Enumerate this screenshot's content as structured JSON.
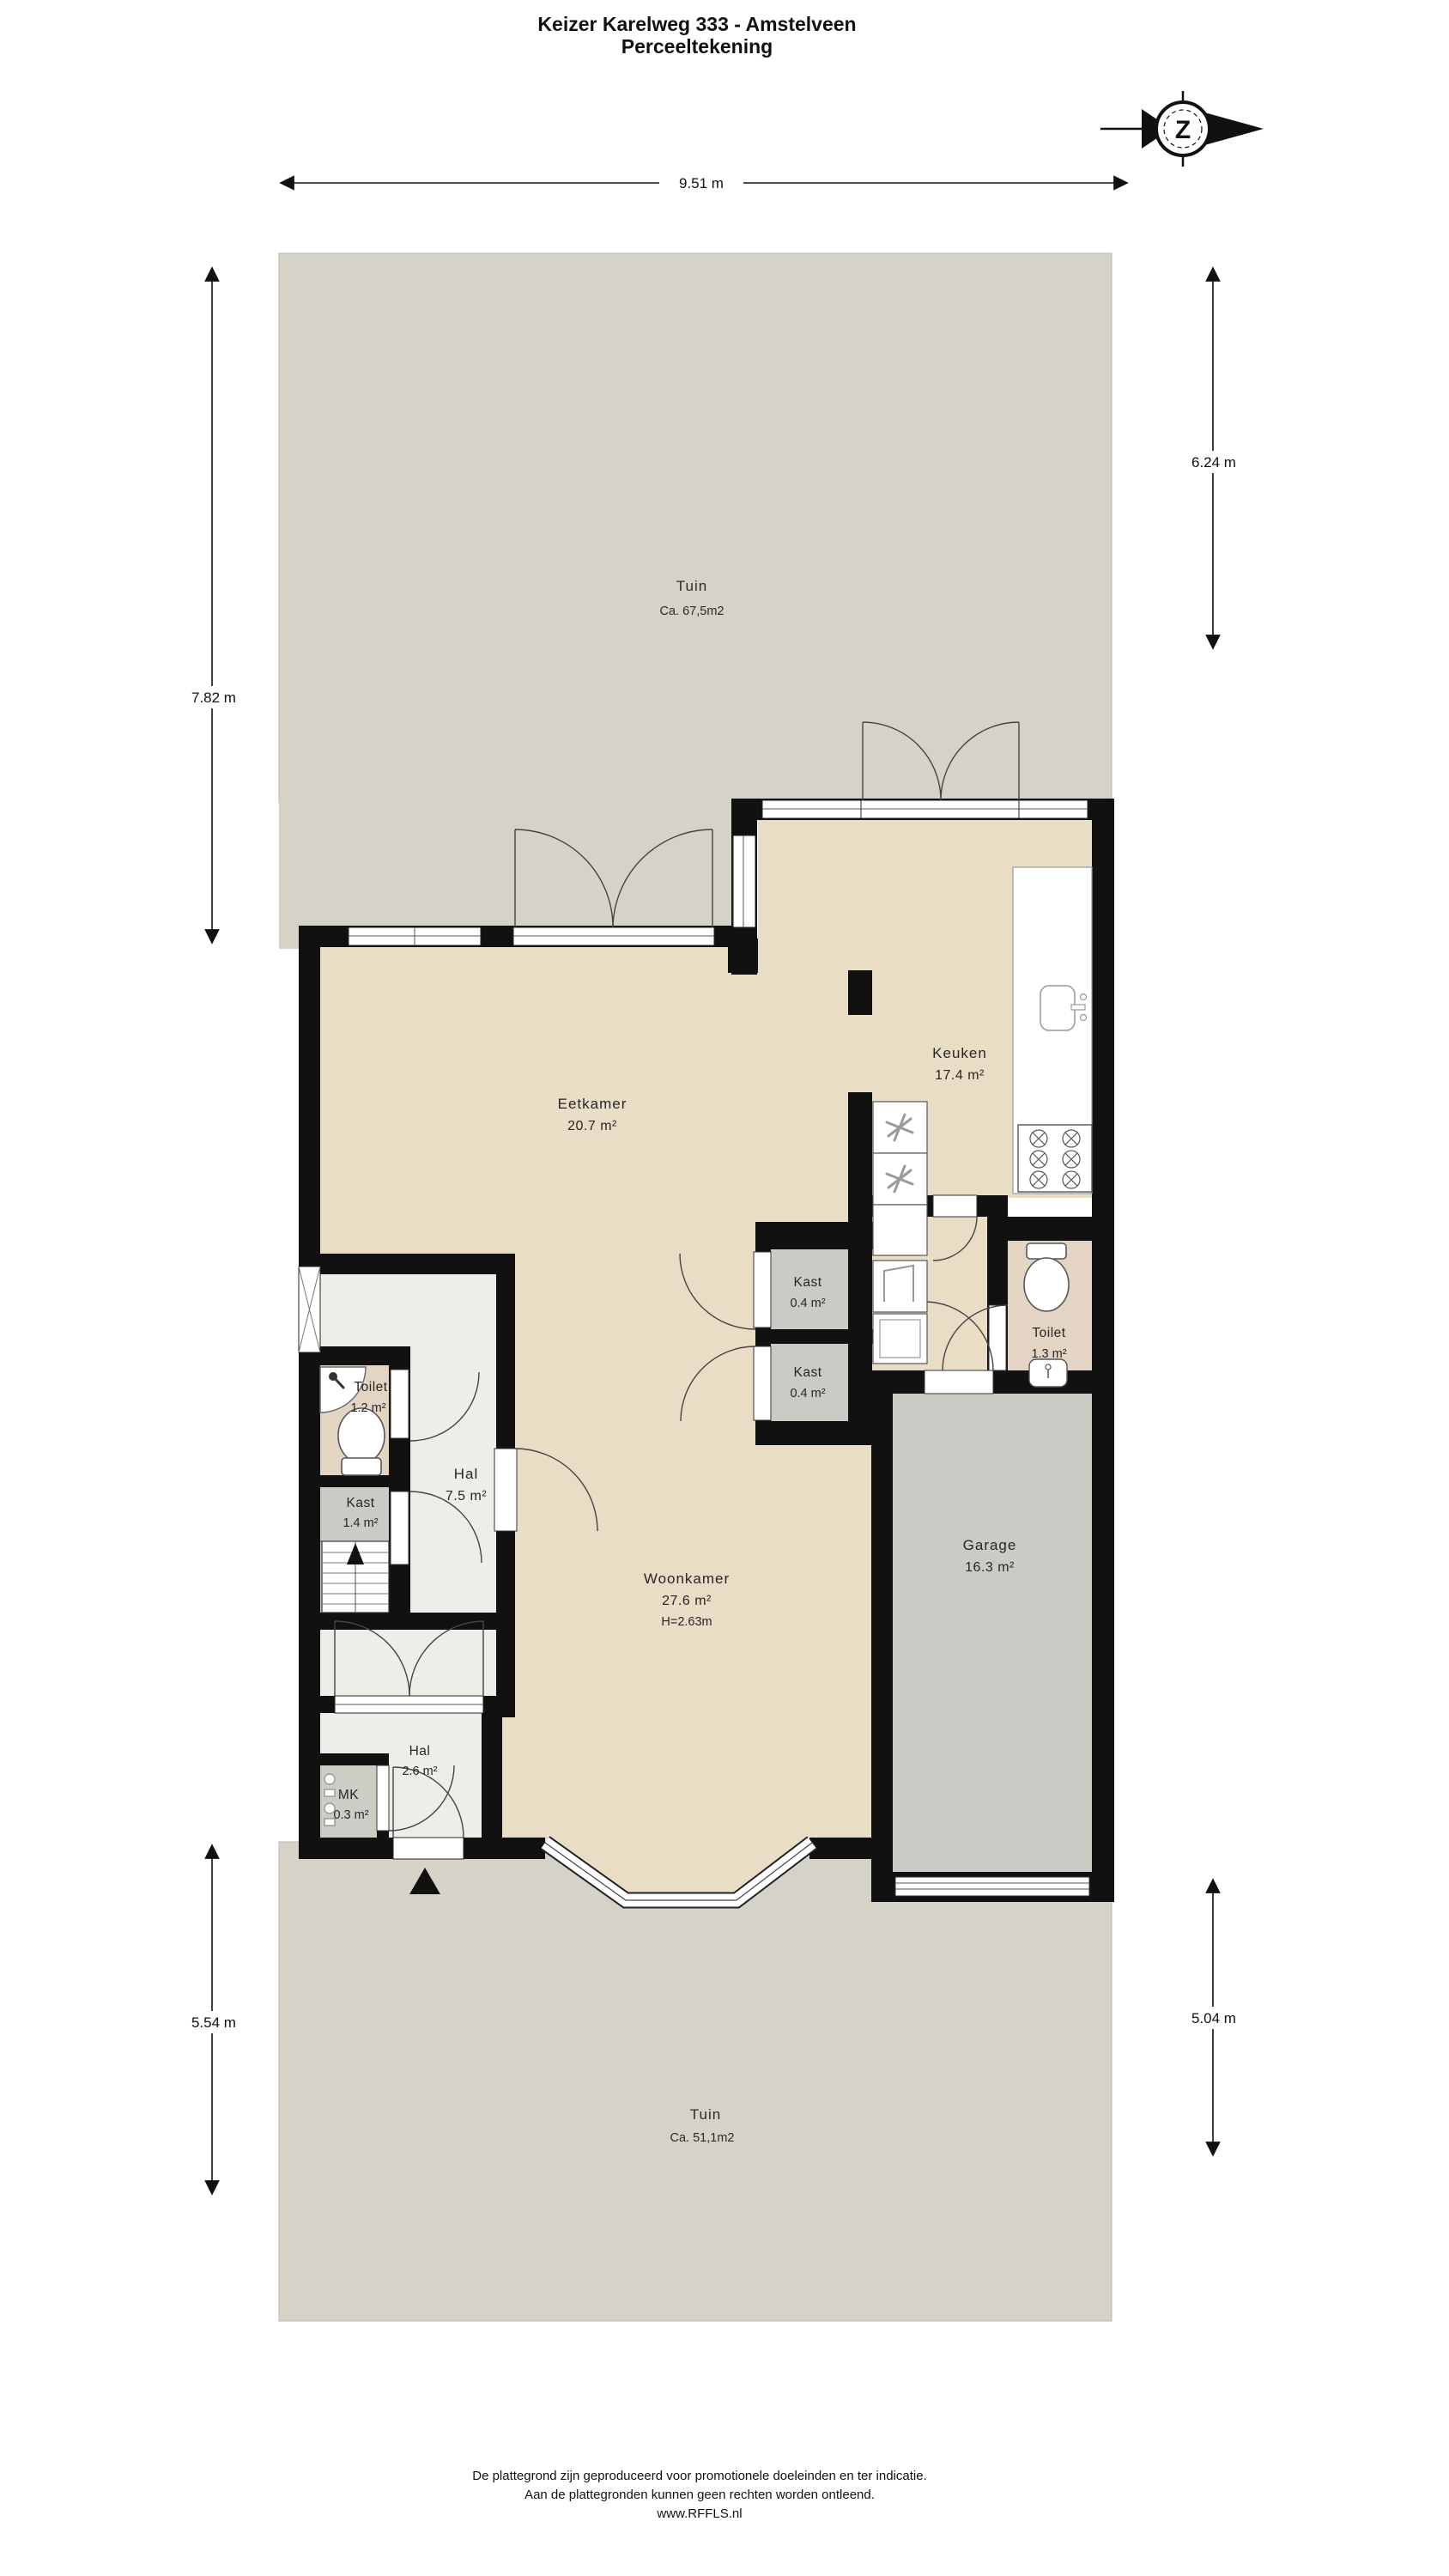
{
  "title": {
    "line1": "Keizer Karelweg 333 - Amstelveen",
    "line2": "Perceeltekening"
  },
  "compass": {
    "letter": "Z"
  },
  "dimensions": {
    "top": "9.51 m",
    "garden_top_left": "7.82 m",
    "garden_top_right": "6.24 m",
    "garden_bottom_left": "5.54 m",
    "garden_bottom_right": "5.04 m"
  },
  "garden_top": {
    "name": "Tuin",
    "area": "Ca. 67,5m2"
  },
  "garden_bottom": {
    "name": "Tuin",
    "area": "Ca. 51,1m2"
  },
  "rooms": {
    "eetkamer": {
      "name": "Eetkamer",
      "area": "20.7 m²"
    },
    "keuken": {
      "name": "Keuken",
      "area": "17.4 m²"
    },
    "woonkamer": {
      "name": "Woonkamer",
      "area": "27.6 m²",
      "ceiling_height": "H=2.63m"
    },
    "garage": {
      "name": "Garage",
      "area": "16.3 m²"
    },
    "hal": {
      "name": "Hal",
      "area": "7.5 m²"
    },
    "hal_entree": {
      "name": "Hal",
      "area": "2.6 m²"
    },
    "toilet_hal": {
      "name": "Toilet",
      "area": "1.2 m²"
    },
    "toilet_garage": {
      "name": "Toilet",
      "area": "1.3 m²"
    },
    "kast_hal": {
      "name": "Kast",
      "area": "1.4 m²"
    },
    "kast_boven": {
      "name": "Kast",
      "area": "0.4 m²"
    },
    "kast_onder": {
      "name": "Kast",
      "area": "0.4 m²"
    },
    "meterkast": {
      "name": "MK",
      "area": "0.3 m²"
    }
  },
  "footer": {
    "line1": "De plattegrond zijn geproduceerd voor promotionele doeleinden en ter indicatie.",
    "line2": "Aan de plattegronden kunnen geen rechten worden ontleend.",
    "line3": "www.RFFLS.nl"
  },
  "colors": {
    "garden": "#d5d2c8",
    "floor": "#e9ddc6",
    "floor_hal": "#efede7",
    "floor_closet": "#c9ccc4",
    "floor_toilet": "#e4d4c4",
    "wall": "#111111"
  }
}
